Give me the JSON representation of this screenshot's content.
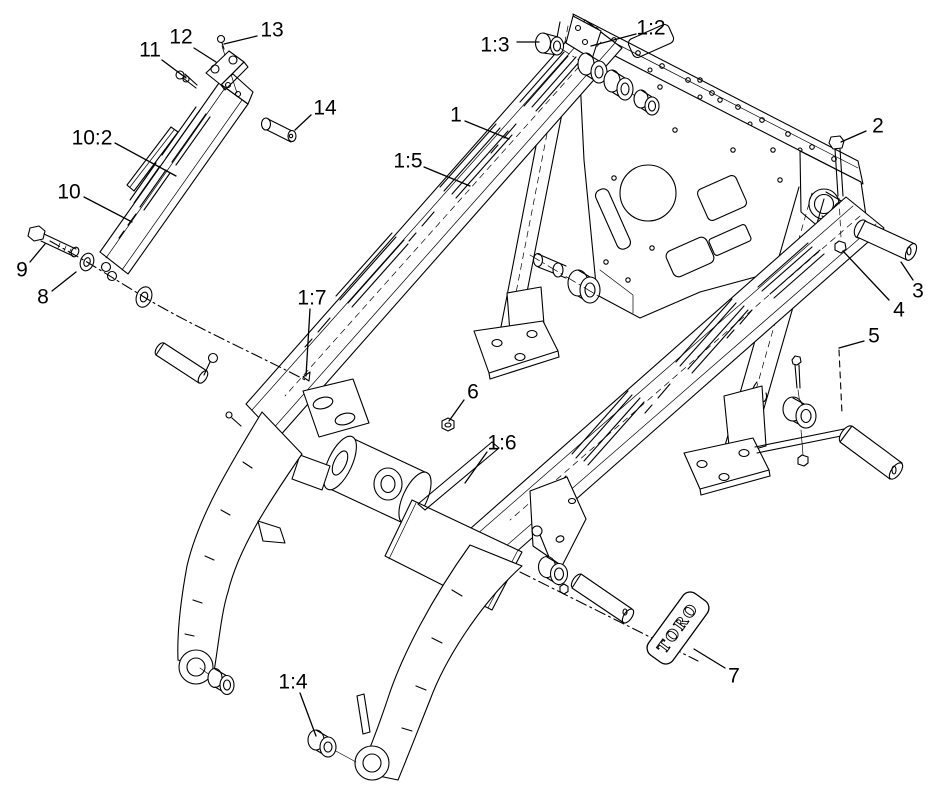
{
  "diagram": {
    "background_color": "#ffffff",
    "line_color": "#000000",
    "brand_plate": {
      "text": "TORO"
    },
    "callouts": [
      {
        "label": "13",
        "x": 272,
        "y": 30,
        "leader": [
          [
            257,
            36
          ],
          [
            224,
            44
          ]
        ]
      },
      {
        "label": "12",
        "x": 181,
        "y": 37,
        "leader": [
          [
            194,
            48
          ],
          [
            216,
            62
          ]
        ]
      },
      {
        "label": "11",
        "x": 150,
        "y": 50,
        "leader": [
          [
            162,
            60
          ],
          [
            186,
            78
          ]
        ]
      },
      {
        "label": "14",
        "x": 325,
        "y": 108,
        "leader": [
          [
            311,
            115
          ],
          [
            295,
            130
          ]
        ]
      },
      {
        "label": "10:2",
        "x": 92,
        "y": 138,
        "leader": [
          [
            115,
            143
          ],
          [
            176,
            176
          ]
        ]
      },
      {
        "label": "10",
        "x": 69,
        "y": 192,
        "leader": [
          [
            84,
            197
          ],
          [
            132,
            222
          ]
        ]
      },
      {
        "label": "9",
        "x": 22,
        "y": 270,
        "leader": [
          [
            30,
            262
          ],
          [
            45,
            244
          ]
        ]
      },
      {
        "label": "8",
        "x": 43,
        "y": 297,
        "leader": [
          [
            52,
            291
          ],
          [
            76,
            272
          ]
        ]
      },
      {
        "label": "1:3",
        "x": 495,
        "y": 45,
        "leader": [
          [
            517,
            42
          ],
          [
            539,
            42
          ]
        ]
      },
      {
        "label": "1:2",
        "x": 651,
        "y": 28,
        "leader": [
          [
            636,
            34
          ],
          [
            591,
            46
          ]
        ]
      },
      {
        "label": "1",
        "x": 456,
        "y": 115,
        "leader": [
          [
            465,
            121
          ],
          [
            509,
            139
          ]
        ]
      },
      {
        "label": "2",
        "x": 878,
        "y": 126,
        "leader": [
          [
            866,
            131
          ],
          [
            841,
            142
          ]
        ]
      },
      {
        "label": "1:5",
        "x": 408,
        "y": 161,
        "leader": [
          [
            424,
            167
          ],
          [
            470,
            186
          ]
        ]
      },
      {
        "label": "3",
        "x": 918,
        "y": 291,
        "leader": [
          [
            913,
            280
          ],
          [
            901,
            262
          ]
        ]
      },
      {
        "label": "4",
        "x": 899,
        "y": 310,
        "leader": [
          [
            889,
            300
          ],
          [
            843,
            251
          ]
        ]
      },
      {
        "label": "5",
        "x": 874,
        "y": 336,
        "leader": [
          [
            864,
            341
          ],
          [
            839,
            348
          ]
        ]
      },
      {
        "label": "1:7",
        "x": 312,
        "y": 298,
        "leader": [
          [
            310,
            309
          ],
          [
            306,
            376
          ]
        ]
      },
      {
        "label": "6",
        "x": 473,
        "y": 392,
        "leader": [
          [
            464,
            400
          ],
          [
            449,
            421
          ]
        ]
      },
      {
        "label": "1:6",
        "x": 502,
        "y": 443,
        "leader": [
          [
            487,
            452
          ],
          [
            465,
            483
          ]
        ]
      },
      {
        "label": "1:4",
        "x": 293,
        "y": 682,
        "leader": [
          [
            300,
            693
          ],
          [
            316,
            736
          ]
        ]
      },
      {
        "label": "7",
        "x": 734,
        "y": 676,
        "leader": [
          [
            725,
            668
          ],
          [
            694,
            649
          ]
        ]
      }
    ]
  }
}
